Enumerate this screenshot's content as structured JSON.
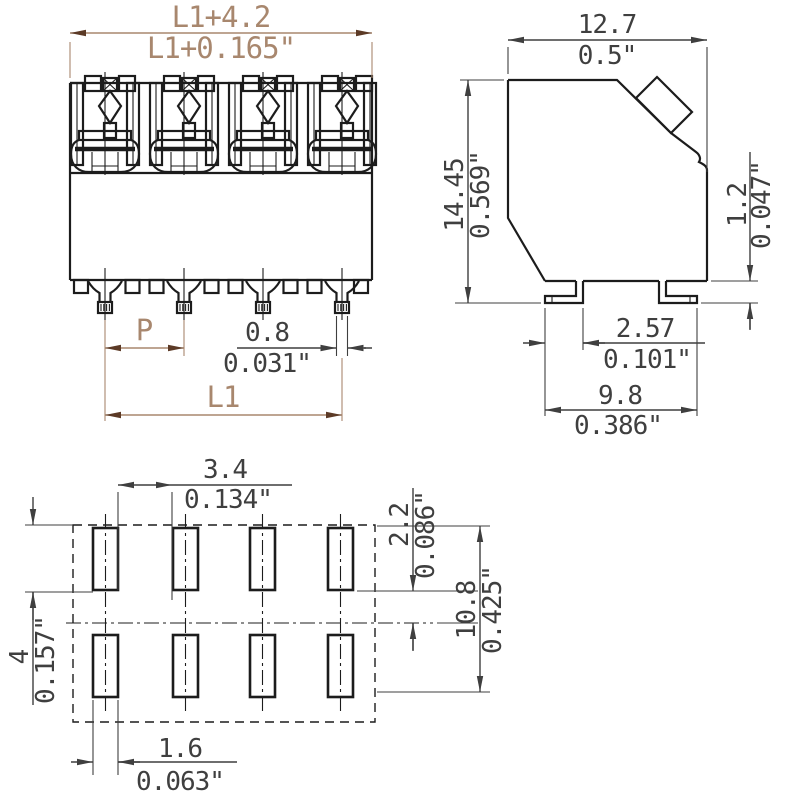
{
  "drawing_type": "terminal-block-dimensional-drawing",
  "front": {
    "overall_width_mm": "L1+4.2",
    "overall_width_in": "L1+0.165\"",
    "pitch_label": "P",
    "pin_width_mm": "0.8",
    "pin_width_in": "0.031\"",
    "pin_span_label": "L1"
  },
  "side": {
    "width_mm": "12.7",
    "width_in": "0.5\"",
    "height_mm": "14.45",
    "height_in": "0.569\"",
    "standoff_mm": "1.2",
    "standoff_in": "0.047\"",
    "foot_mm": "2.57",
    "foot_in": "0.101\"",
    "span_mm": "9.8",
    "span_in": "0.386\""
  },
  "footprint": {
    "pad_gap_mm": "3.4",
    "pad_gap_in": "0.134\"",
    "pad_height_mm": "2.2",
    "pad_height_in": "0.086\"",
    "row_span_mm": "10.8",
    "row_span_in": "0.425\"",
    "edge_mm": "4",
    "edge_in": "0.157\"",
    "pad_width_mm": "1.6",
    "pad_width_in": "0.063\""
  },
  "colors": {
    "line": "#1c1c1c",
    "dim": "#3f3f3f",
    "front_dim": "#a8876e",
    "front_dim_arrow": "#5c3a26",
    "background": "#ffffff"
  }
}
